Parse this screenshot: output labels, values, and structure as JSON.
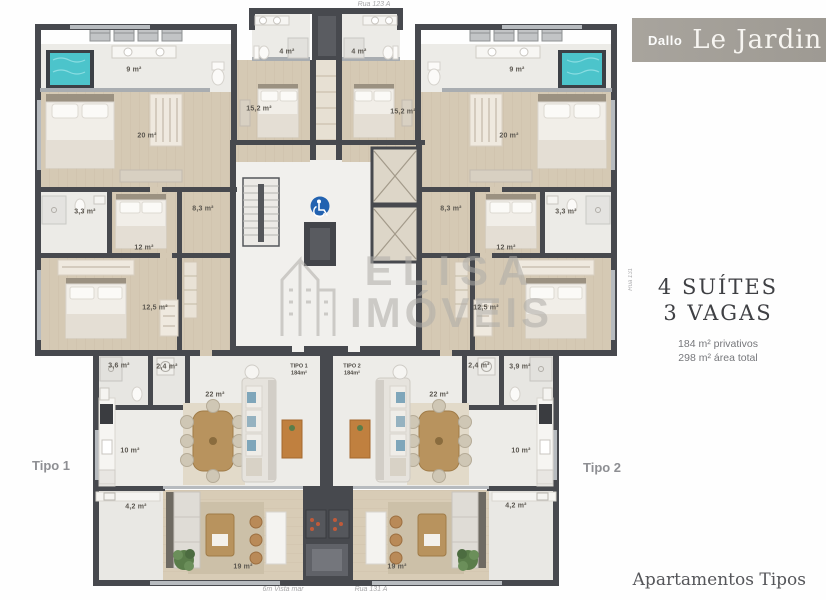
{
  "branding": {
    "developer": "Dallo",
    "project": "Le Jardin"
  },
  "specs": {
    "suites": "4 SUÍTES",
    "parking": "3 VAGAS",
    "private_area": "184 m² privativos",
    "total_area": "298 m² área total"
  },
  "footer": {
    "caption": "Apartamentos Tipos"
  },
  "units": {
    "tipo1": {
      "label": "Tipo 1",
      "entry_name": "TIPO 1",
      "entry_area": "184m²"
    },
    "tipo2": {
      "label": "Tipo 2",
      "entry_name": "TIPO 2",
      "entry_area": "184m²"
    }
  },
  "streets": {
    "top": "Rua 123 A",
    "bottom": "Rua 131 A",
    "side": "Rua 131",
    "view_note": "6m Vista mar"
  },
  "watermark": {
    "line1": "ELISA",
    "line2": "IMÓVEIS"
  },
  "colors": {
    "wall": "#47494e",
    "wood": "#d5c9b4",
    "tile": "#ecebe7",
    "jacuzzi": "#4cc4cb",
    "accessibility_blue": "#2262b0",
    "banner": "#a5a19a"
  },
  "plan": {
    "rooms": [
      {
        "label": "9 m²",
        "x": 134,
        "y": 70
      },
      {
        "label": "20 m²",
        "x": 147,
        "y": 136
      },
      {
        "label": "3,3 m²",
        "x": 85,
        "y": 212
      },
      {
        "label": "12 m²",
        "x": 144,
        "y": 248
      },
      {
        "label": "8,3 m²",
        "x": 203,
        "y": 209
      },
      {
        "label": "12,5 m²",
        "x": 155,
        "y": 308
      },
      {
        "label": "3,6 m²",
        "x": 119,
        "y": 366
      },
      {
        "label": "2,4 m²",
        "x": 167,
        "y": 367
      },
      {
        "label": "22 m²",
        "x": 215,
        "y": 395
      },
      {
        "label": "10 m²",
        "x": 130,
        "y": 451
      },
      {
        "label": "4,2 m²",
        "x": 136,
        "y": 507
      },
      {
        "label": "19 m²",
        "x": 243,
        "y": 567
      },
      {
        "label": "4 m²",
        "x": 287,
        "y": 52
      },
      {
        "label": "15,2 m²",
        "x": 259,
        "y": 109
      },
      {
        "label": "4 m²",
        "x": 359,
        "y": 52
      },
      {
        "label": "15,2 m²",
        "x": 403,
        "y": 112
      },
      {
        "label": "9 m²",
        "x": 517,
        "y": 70
      },
      {
        "label": "20 m²",
        "x": 509,
        "y": 136
      },
      {
        "label": "3,3 m²",
        "x": 566,
        "y": 212
      },
      {
        "label": "12 m²",
        "x": 506,
        "y": 248
      },
      {
        "label": "8,3 m²",
        "x": 451,
        "y": 209
      },
      {
        "label": "12,5 m²",
        "x": 486,
        "y": 308
      },
      {
        "label": "2,4 m²",
        "x": 479,
        "y": 366
      },
      {
        "label": "3,9 m²",
        "x": 520,
        "y": 367
      },
      {
        "label": "22 m²",
        "x": 439,
        "y": 395
      },
      {
        "label": "10 m²",
        "x": 521,
        "y": 451
      },
      {
        "label": "4,2 m²",
        "x": 516,
        "y": 506
      },
      {
        "label": "19 m²",
        "x": 397,
        "y": 567
      }
    ]
  }
}
